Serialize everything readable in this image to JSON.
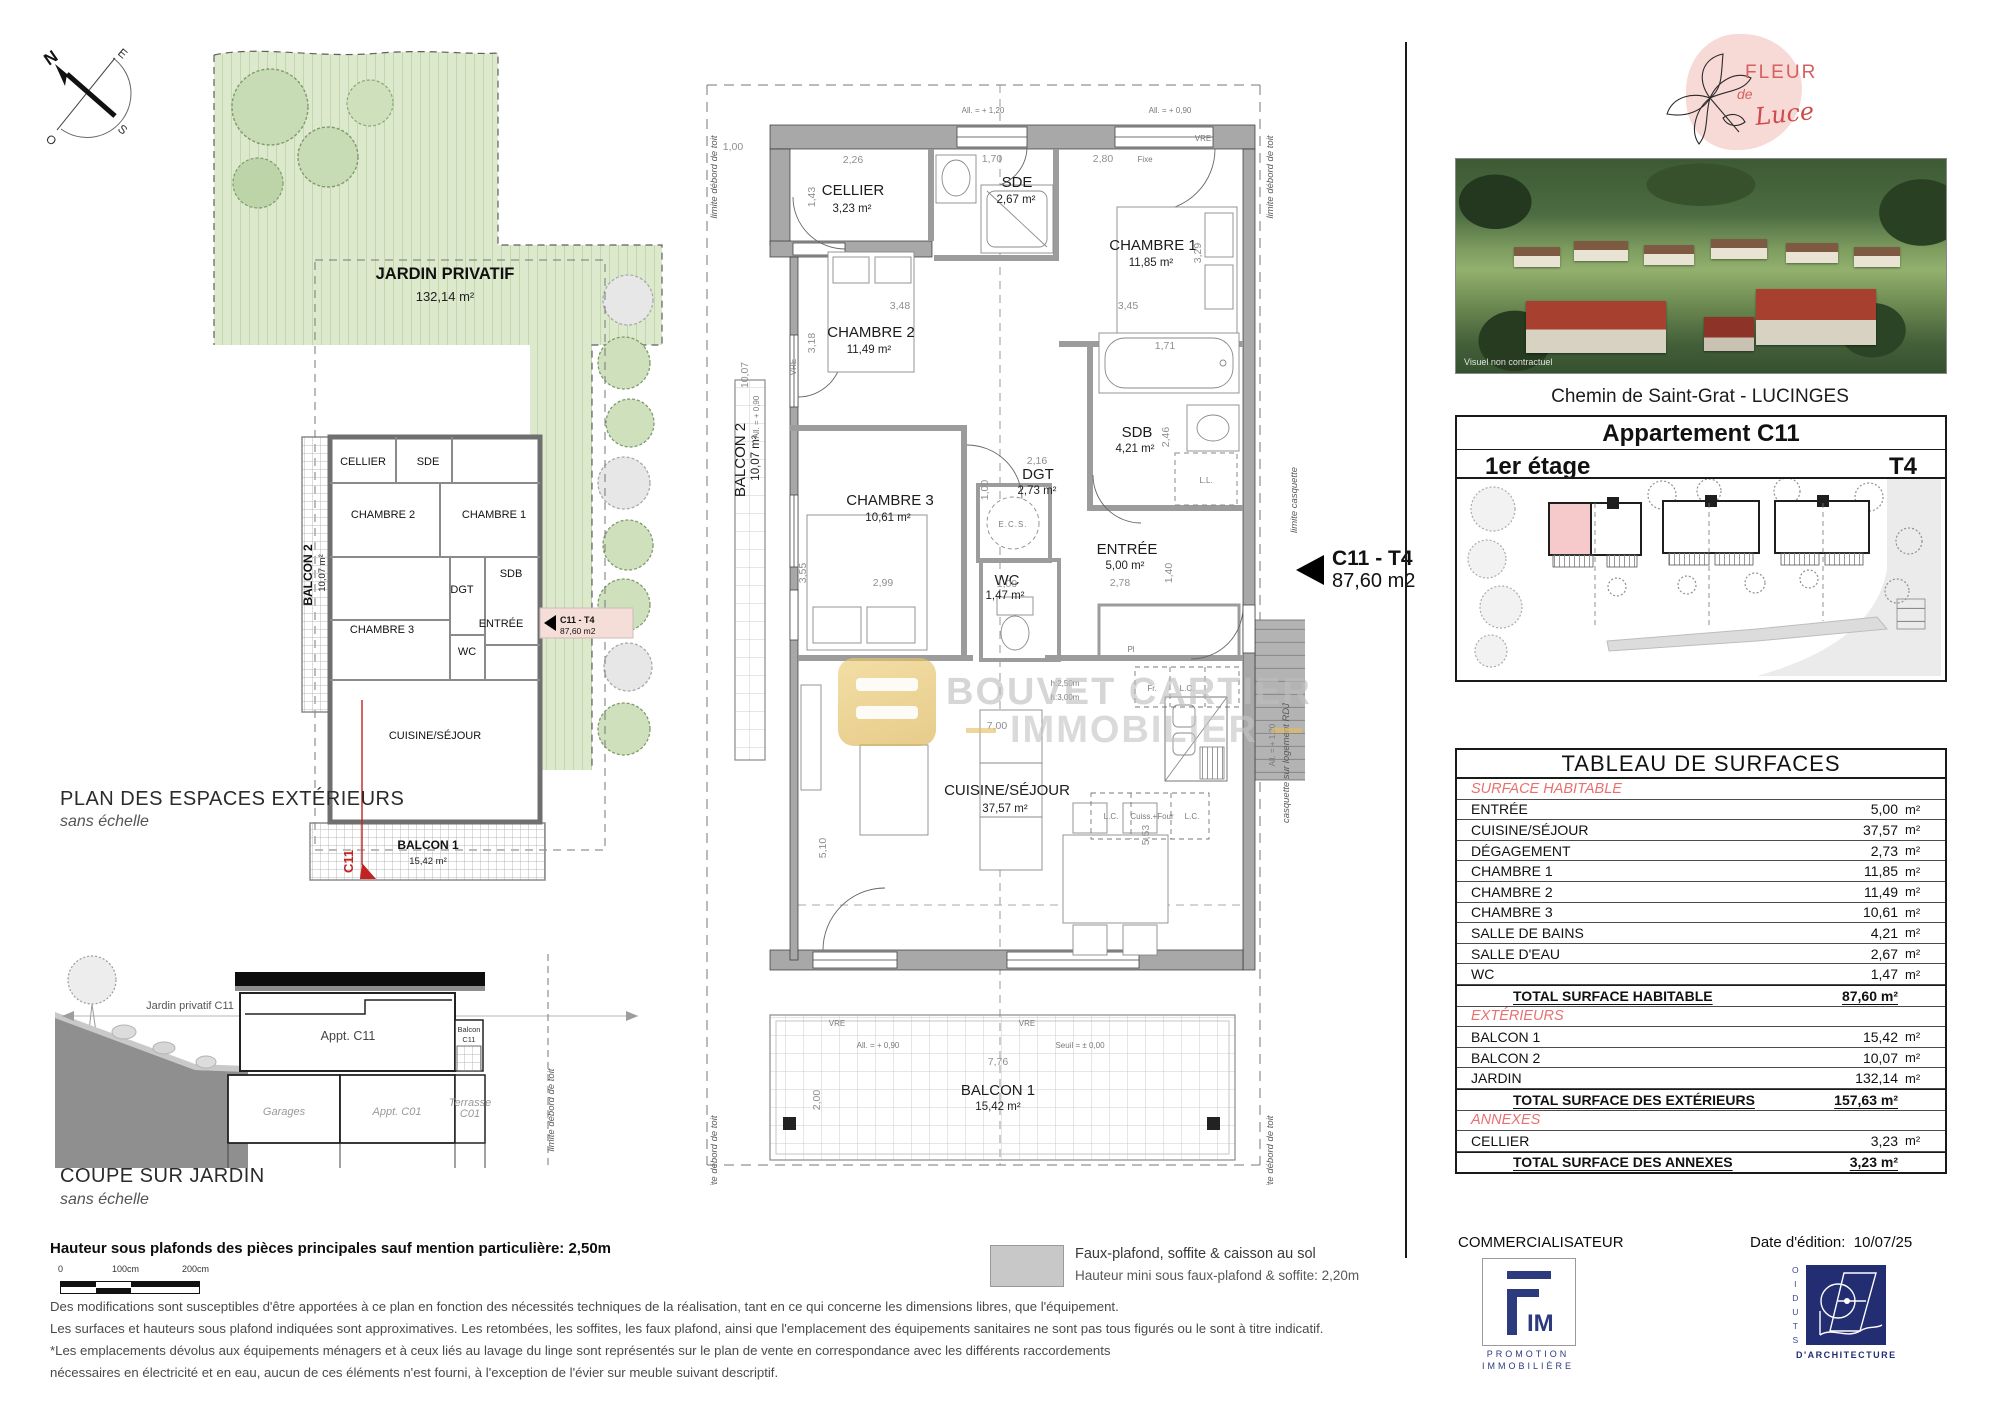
{
  "compass": {
    "n": "N",
    "e": "E",
    "s": "S",
    "o": "O"
  },
  "exterior_plan": {
    "jardin": "JARDIN PRIVATIF",
    "jardin_area": "132,14 m²",
    "caption": "PLAN DES ESPACES EXTÉRIEURS",
    "caption_sub": "sans échelle",
    "c11_red": "C11"
  },
  "coupe": {
    "caption": "COUPE SUR JARDIN",
    "caption_sub": "sans échelle",
    "jardin": "Jardin privatif C11",
    "appt": "Appt. C11",
    "balcon_l1": "Balcon",
    "balcon_l2": "C11",
    "garages": "Garages",
    "appt_c01": "Appt. C01",
    "terrasse_l1": "Terrasse",
    "terrasse_l2": "C01"
  },
  "main_plan": {
    "rooms": {
      "cellier": {
        "name": "CELLIER",
        "area": "3,23 m²"
      },
      "sde": {
        "name": "SDE",
        "area": "2,67 m²"
      },
      "chambre1": {
        "name": "CHAMBRE 1",
        "area": "11,85 m²"
      },
      "chambre2": {
        "name": "CHAMBRE 2",
        "area": "11,49 m²"
      },
      "chambre3": {
        "name": "CHAMBRE 3",
        "area": "10,61 m²"
      },
      "sdb": {
        "name": "SDB",
        "area": "4,21 m²"
      },
      "dgt": {
        "name": "DGT",
        "area": "2,73 m²"
      },
      "wc": {
        "name": "WC",
        "area": "1,47 m²"
      },
      "entree": {
        "name": "ENTRÉE",
        "area": "5,00 m²"
      },
      "cuisine": {
        "name": "CUISINE/SÉJOUR",
        "area": "37,57 m²"
      },
      "balcon1": {
        "name": "BALCON 1",
        "area": "15,42 m²"
      },
      "balcon2": {
        "name": "BALCON 2",
        "area": "10,07 m²"
      }
    },
    "dims": {
      "cellier_w": "2,26",
      "cellier_h": "1,43",
      "sde_w": "1,70",
      "ch1_w": "2,80",
      "ch2_w": "3,48",
      "ch2_h": "3,18",
      "ch1_w2": "3,45",
      "ch1_h": "3,29",
      "bath_w": "1,71",
      "sdb_h": "2,46",
      "dgt_w": "2,16",
      "dgt_h": "1,00",
      "ch3_w": "2,99",
      "ch3_h": "3,55",
      "wc_w": "1,09",
      "entree_w": "2,78",
      "entree_h": "1,40",
      "sejour_h": "5,10",
      "sejour_w": "7,00",
      "cuisine_h": "5,53",
      "balcon1_w": "7,76",
      "balcon1_h": "2,00",
      "balcon2_h": "10,07",
      "corner": "1,00"
    },
    "annotations": {
      "all120": "All. = + 1,20",
      "all090": "All. = + 0,90",
      "seuil": "Seuil = ± 0,00",
      "vre": "VRE",
      "fixe": "Fixe",
      "limite_toit": "limite débord de toit",
      "limite_casquette": "limite casquette",
      "casquette": "casquette sur logement RDJ",
      "ecs": "E.C.S.",
      "h250": "h:2,50m",
      "h300": "h:3,00m",
      "fr": "Fr.",
      "lc": "L.C.",
      "cuiss": "Cuiss.+Four",
      "pl": "Pl",
      "ll": "L.L."
    }
  },
  "unit_callout": {
    "title": "C11 - T4",
    "area": "87,60 m2"
  },
  "watermark": {
    "l1": "BOUVET CARTIER",
    "l2": "IMMOBILIER"
  },
  "right_panel": {
    "brand": {
      "fleur": "FLEUR",
      "de": "de",
      "luce": "Luce"
    },
    "photo_note": "Visuel non contractuel",
    "address": "Chemin de Saint-Grat - LUCINGES",
    "apt_title": "Appartement C11",
    "floor": "1er étage",
    "type": "T4",
    "table": {
      "title": "TABLEAU DE SURFACES",
      "rows": [
        {
          "t": "sect",
          "label": "SURFACE HABITABLE"
        },
        {
          "t": "row",
          "label": "ENTRÉE",
          "value": "5,00",
          "unit": "m²"
        },
        {
          "t": "row",
          "label": "CUISINE/SÉJOUR",
          "value": "37,57",
          "unit": "m²"
        },
        {
          "t": "row",
          "label": "DÉGAGEMENT",
          "value": "2,73",
          "unit": "m²"
        },
        {
          "t": "row",
          "label": "CHAMBRE 1",
          "value": "11,85",
          "unit": "m²"
        },
        {
          "t": "row",
          "label": "CHAMBRE 2",
          "value": "11,49",
          "unit": "m²"
        },
        {
          "t": "row",
          "label": "CHAMBRE 3",
          "value": "10,61",
          "unit": "m²"
        },
        {
          "t": "row",
          "label": "SALLE DE BAINS",
          "value": "4,21",
          "unit": "m²"
        },
        {
          "t": "row",
          "label": "SALLE D'EAU",
          "value": "2,67",
          "unit": "m²"
        },
        {
          "t": "row",
          "label": "WC",
          "value": "1,47",
          "unit": "m²"
        },
        {
          "t": "total",
          "label": "TOTAL SURFACE HABITABLE",
          "value": "87,60 m²"
        },
        {
          "t": "sect",
          "label": "EXTÉRIEURS"
        },
        {
          "t": "row",
          "label": "BALCON 1",
          "value": "15,42",
          "unit": "m²"
        },
        {
          "t": "row",
          "label": "BALCON 2",
          "value": "10,07",
          "unit": "m²"
        },
        {
          "t": "row",
          "label": "JARDIN",
          "value": "132,14",
          "unit": "m²"
        },
        {
          "t": "total",
          "label": "TOTAL SURFACE DES EXTÉRIEURS",
          "value": "157,63 m²"
        },
        {
          "t": "sect",
          "label": "ANNEXES"
        },
        {
          "t": "row",
          "label": "CELLIER",
          "value": "3,23",
          "unit": "m²"
        },
        {
          "t": "total",
          "label": "TOTAL SURFACE DES ANNEXES",
          "value": "3,23 m²"
        }
      ]
    },
    "commercialisateur": "COMMERCIALISATEUR",
    "date_label": "Date d'édition:",
    "date_value": "10/07/25",
    "fim": {
      "im": "IM",
      "sub1": "PROMOTION",
      "sub2": "IMMOBILIÈRE"
    },
    "studio": {
      "vertical": "STUDIO",
      "bottom": "D'ARCHITECTURE"
    }
  },
  "notes": {
    "ceiling": "Hauteur sous plafonds des pièces principales sauf mention particulière: 2,50m",
    "scale0": "0",
    "scale100": "100cm",
    "scale200": "200cm",
    "legend1": "Faux-plafond, soffite & caisson au sol",
    "legend2": "Hauteur mini sous faux-plafond & soffite: 2,20m",
    "para1": "Des modifications sont susceptibles d'être apportées à ce plan en fonction des nécessités techniques de la réalisation, tant en ce qui concerne les dimensions libres, que l'équipement.",
    "para2": "Les surfaces et hauteurs sous plafond indiquées sont approximatives. Les retombées, les soffites, les faux plafond, ainsi que l'emplacement des équipements sanitaires ne sont pas tous figurés ou le sont à titre indicatif.",
    "para3": "*Les emplacements dévolus aux équipements ménagers et à ceux liés au lavage du linge sont représentés sur le plan de vente en correspondance avec les différents raccordements",
    "para4": "nécessaires en électricité et en eau, aucun de ces éléments n'est fourni, à l'exception de l'évier sur meuble suivant descriptif."
  }
}
